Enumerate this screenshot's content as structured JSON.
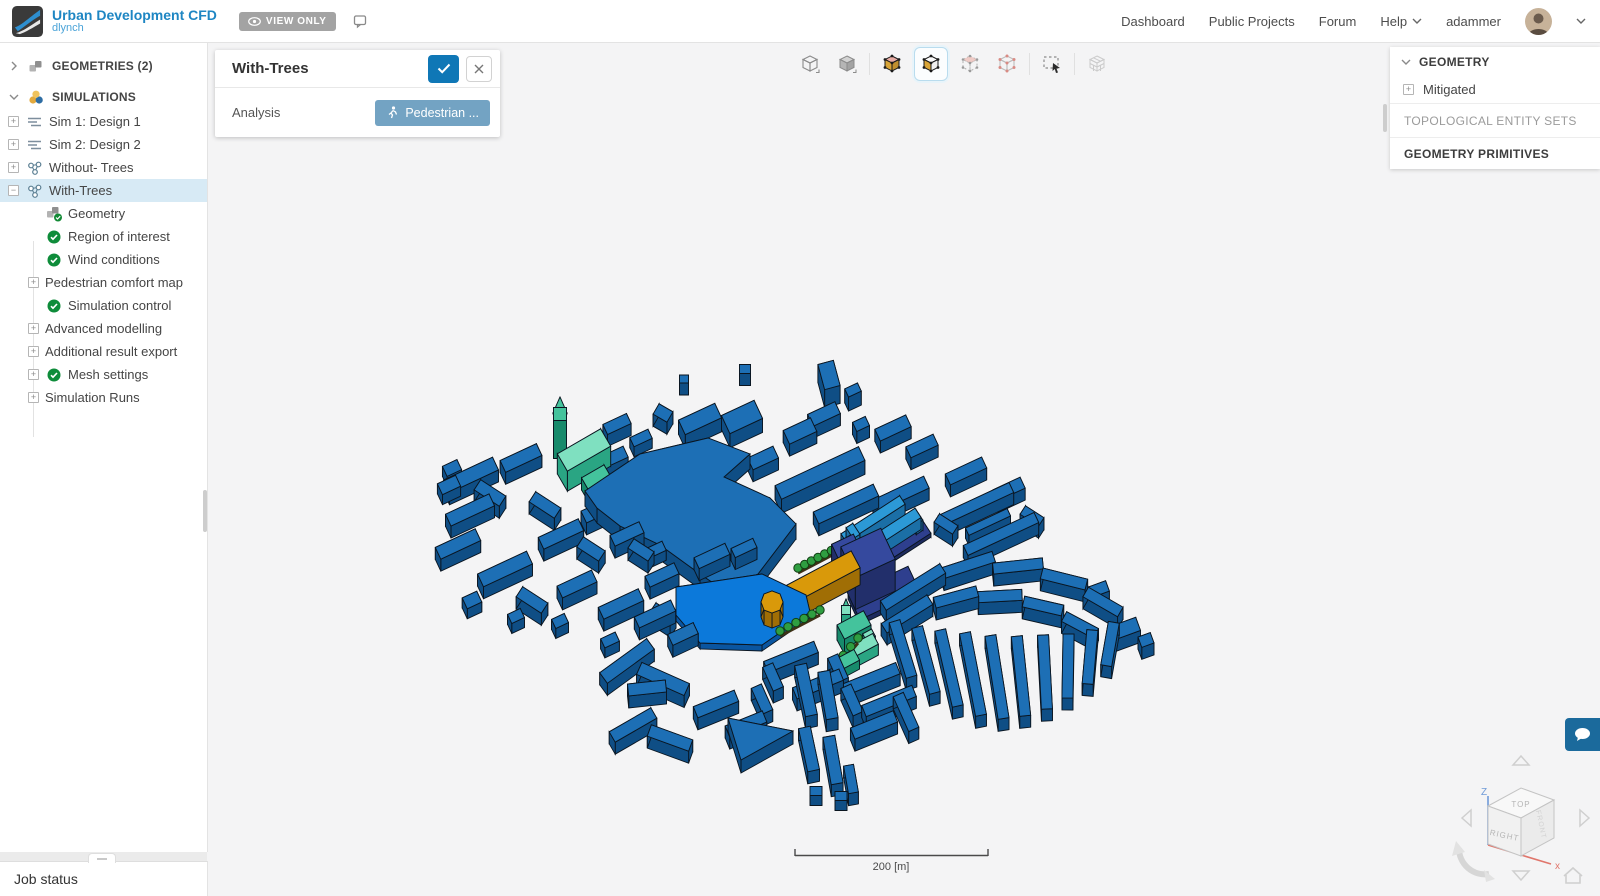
{
  "header": {
    "brand": {
      "title": "Urban Development CFD",
      "owner": "dlynch"
    },
    "view_only_label": "VIEW ONLY",
    "nav": {
      "dashboard": "Dashboard",
      "public_projects": "Public Projects",
      "forum": "Forum",
      "help": "Help",
      "username": "adammer"
    }
  },
  "sidebar": {
    "tree": [
      {
        "label": "GEOMETRIES (2)"
      },
      {
        "label": "SIMULATIONS"
      },
      {
        "label": "Sim 1: Design 1"
      },
      {
        "label": "Sim 2: Design 2"
      },
      {
        "label": "Without- Trees"
      },
      {
        "label": "With-Trees"
      },
      {
        "label": "Geometry"
      },
      {
        "label": "Region of interest"
      },
      {
        "label": "Wind conditions"
      },
      {
        "label": "Pedestrian comfort map"
      },
      {
        "label": "Simulation control"
      },
      {
        "label": "Advanced modelling"
      },
      {
        "label": "Additional result export"
      },
      {
        "label": "Mesh settings"
      },
      {
        "label": "Simulation Runs"
      }
    ],
    "job_status_label": "Job status"
  },
  "panel": {
    "title": "With-Trees",
    "field_label": "Analysis",
    "field_value": "Pedestrian ..."
  },
  "toolbar": {
    "icons": [
      "wireframe-view",
      "solid-view",
      "shaded-with-edges-view",
      "shaded-view",
      "vertex-selection-view",
      "primitive-selection-view",
      "box-select-tool",
      "mesh-view"
    ]
  },
  "right_panel": {
    "geometry_label": "GEOMETRY",
    "mitigated_label": "Mitigated",
    "topological_label": "TOPOLOGICAL ENTITY SETS",
    "primitives_label": "GEOMETRY PRIMITIVES"
  },
  "viewport": {
    "scale_label": "200 [m]",
    "cube": {
      "top": "TOP",
      "front": "RIGHT",
      "side": "FRONT",
      "z_axis": "Z",
      "x_axis": "x"
    },
    "colors": {
      "stroke": "#0a1520",
      "b": {
        "t": "#1d6fb5",
        "s": "#0f4e85"
      },
      "p": {
        "t": "#0c79da",
        "s": "#0a55a0"
      },
      "o": {
        "t": "#d9990a",
        "s": "#a06e05"
      },
      "n": {
        "t": "#35499e",
        "s": "#222f6b"
      },
      "np": {
        "t": "#2e3f8e",
        "s": "#1d2a5e"
      },
      "c": {
        "t": "#2c99d6",
        "s": "#1b6fa6"
      },
      "m": {
        "t": "#7fe0c0",
        "s": "#2aa583"
      },
      "m2": {
        "t": "#44c39c",
        "s": "#178a6b"
      }
    },
    "tree_color": "#2f9e41",
    "buildings": [
      [
        617,
        436,
        26,
        11,
        -25,
        12,
        "b"
      ],
      [
        641,
        448,
        20,
        10,
        -25,
        10,
        "b"
      ],
      [
        612,
        470,
        30,
        12,
        -25,
        12,
        "b"
      ],
      [
        663,
        425,
        16,
        12,
        30,
        12,
        "b"
      ],
      [
        684,
        391,
        9,
        8,
        0,
        12,
        "b"
      ],
      [
        700,
        433,
        40,
        16,
        -25,
        14,
        "b"
      ],
      [
        745,
        381,
        11,
        9,
        0,
        12,
        "b"
      ],
      [
        742,
        431,
        36,
        20,
        -25,
        14,
        "b"
      ],
      [
        763,
        470,
        28,
        13,
        -25,
        12,
        "b"
      ],
      [
        800,
        443,
        30,
        15,
        -25,
        12,
        "b"
      ],
      [
        829,
        393,
        16,
        26,
        -15,
        18,
        "b"
      ],
      [
        824,
        426,
        30,
        13,
        -25,
        12,
        "b"
      ],
      [
        853,
        404,
        14,
        9,
        -25,
        14,
        "b"
      ],
      [
        861,
        436,
        14,
        10,
        -25,
        12,
        "b"
      ],
      [
        893,
        440,
        34,
        13,
        -25,
        12,
        "b"
      ],
      [
        922,
        458,
        30,
        12,
        -25,
        12,
        "b"
      ],
      [
        452,
        478,
        16,
        11,
        -25,
        10,
        "b"
      ],
      [
        449,
        495,
        20,
        12,
        -25,
        10,
        "b"
      ],
      [
        560,
        452,
        13,
        13,
        0,
        38,
        "m2"
      ],
      [
        584,
        470,
        50,
        20,
        -30,
        20,
        "m"
      ],
      [
        596,
        489,
        26,
        13,
        -30,
        12,
        "m2"
      ],
      [
        606,
        497,
        12,
        10,
        -30,
        10,
        "m2"
      ],
      [
        615,
        487,
        10,
        9,
        -30,
        8,
        "m2"
      ],
      [
        471,
        487,
        54,
        14,
        -25,
        12,
        "b"
      ],
      [
        521,
        470,
        40,
        13,
        -25,
        12,
        "b"
      ],
      [
        490,
        505,
        30,
        12,
        33,
        12,
        "b"
      ],
      [
        470,
        522,
        48,
        13,
        -25,
        12,
        "b"
      ],
      [
        545,
        517,
        30,
        12,
        33,
        12,
        "b"
      ],
      [
        458,
        556,
        44,
        13,
        -25,
        12,
        "b"
      ],
      [
        505,
        581,
        54,
        14,
        -25,
        12,
        "b"
      ],
      [
        561,
        546,
        44,
        13,
        -25,
        12,
        "b"
      ],
      [
        601,
        521,
        38,
        13,
        -25,
        12,
        "b"
      ],
      [
        591,
        561,
        26,
        12,
        33,
        12,
        "b"
      ],
      [
        627,
        546,
        32,
        12,
        -25,
        12,
        "b"
      ],
      [
        641,
        562,
        24,
        11,
        33,
        12,
        "b"
      ],
      [
        532,
        612,
        30,
        12,
        33,
        12,
        "b"
      ],
      [
        577,
        596,
        38,
        13,
        -25,
        12,
        "b"
      ],
      [
        621,
        616,
        44,
        13,
        -25,
        12,
        "b"
      ],
      [
        662,
        587,
        32,
        12,
        -25,
        12,
        "b"
      ],
      [
        663,
        626,
        24,
        11,
        33,
        12,
        "b"
      ],
      [
        472,
        610,
        16,
        12,
        -25,
        10,
        "b"
      ],
      [
        516,
        626,
        14,
        10,
        -25,
        10,
        "b"
      ],
      [
        560,
        631,
        14,
        10,
        -25,
        10,
        "b"
      ],
      [
        655,
        560,
        20,
        10,
        -25,
        10,
        "b"
      ],
      [
        712,
        568,
        34,
        12,
        -25,
        12,
        "b"
      ],
      [
        744,
        560,
        24,
        10,
        -25,
        12,
        "b"
      ],
      [
        655,
        626,
        40,
        12,
        -25,
        12,
        "b"
      ],
      [
        683,
        646,
        28,
        12,
        -25,
        12,
        "b"
      ],
      [
        820,
        487,
        92,
        15,
        -25,
        14,
        "b"
      ],
      [
        846,
        516,
        66,
        13,
        -25,
        12,
        "b"
      ],
      [
        901,
        506,
        56,
        13,
        -25,
        12,
        "b"
      ],
      [
        966,
        483,
        40,
        12,
        -25,
        12,
        "b"
      ],
      [
        1009,
        501,
        30,
        12,
        -25,
        12,
        "b"
      ],
      [
        976,
        516,
        78,
        11,
        -25,
        12,
        "b"
      ],
      [
        1001,
        546,
        78,
        11,
        -25,
        12,
        "b"
      ],
      [
        946,
        536,
        22,
        10,
        33,
        12,
        "b"
      ],
      [
        1032,
        528,
        22,
        10,
        33,
        12,
        "b"
      ],
      [
        988,
        532,
        46,
        8,
        -25,
        10,
        "b"
      ],
      [
        888,
        552,
        88,
        22,
        -33,
        4,
        "np",
        518
      ],
      [
        873,
        531,
        70,
        10,
        -33,
        12,
        "c"
      ],
      [
        887,
        545,
        74,
        11,
        -33,
        12,
        "c"
      ],
      [
        853,
        541,
        13,
        8,
        57,
        10,
        "c"
      ],
      [
        916,
        527,
        13,
        8,
        57,
        10,
        "c"
      ],
      [
        848,
        577,
        24,
        26,
        -25,
        26,
        "n"
      ],
      [
        868,
        585,
        44,
        34,
        -25,
        32,
        "n"
      ],
      [
        884,
        598,
        66,
        28,
        -25,
        5,
        "np",
        560
      ],
      [
        815,
        598,
        92,
        19,
        -28,
        17,
        "o"
      ],
      [
        858,
        578,
        13,
        11,
        -28,
        13,
        "o"
      ],
      [
        854,
        640,
        30,
        16,
        -28,
        15,
        "m2"
      ],
      [
        864,
        656,
        26,
        12,
        -28,
        11,
        "m"
      ],
      [
        847,
        669,
        22,
        12,
        -28,
        9,
        "m2"
      ],
      [
        846,
        634,
        9,
        9,
        0,
        24,
        "m"
      ],
      [
        869,
        643,
        10,
        8,
        -28,
        8,
        "m"
      ],
      [
        913,
        599,
        70,
        11,
        -32,
        12,
        "b"
      ],
      [
        968,
        577,
        54,
        11,
        -18,
        12,
        "b"
      ],
      [
        1018,
        578,
        50,
        11,
        -6,
        12,
        "b"
      ],
      [
        1064,
        591,
        46,
        11,
        14,
        12,
        "b"
      ],
      [
        1103,
        614,
        40,
        11,
        30,
        12,
        "b"
      ],
      [
        907,
        626,
        54,
        11,
        -32,
        12,
        "b"
      ],
      [
        956,
        609,
        44,
        11,
        -15,
        12,
        "b"
      ],
      [
        1000,
        608,
        44,
        11,
        -3,
        12,
        "b"
      ],
      [
        1043,
        618,
        40,
        11,
        13,
        12,
        "b"
      ],
      [
        1080,
        637,
        36,
        11,
        28,
        12,
        "b"
      ],
      [
        903,
        661,
        58,
        11,
        73,
        12,
        "b"
      ],
      [
        926,
        672,
        68,
        11,
        75,
        12,
        "b"
      ],
      [
        949,
        680,
        78,
        11,
        77,
        12,
        "b"
      ],
      [
        973,
        686,
        84,
        11,
        79,
        12,
        "b"
      ],
      [
        997,
        689,
        84,
        11,
        81,
        12,
        "b"
      ],
      [
        1021,
        688,
        80,
        11,
        84,
        12,
        "b"
      ],
      [
        1045,
        684,
        74,
        11,
        87,
        12,
        "b"
      ],
      [
        1068,
        678,
        64,
        11,
        91,
        12,
        "b"
      ],
      [
        1090,
        669,
        54,
        11,
        95,
        12,
        "b"
      ],
      [
        1110,
        656,
        44,
        11,
        100,
        12,
        "b"
      ],
      [
        1124,
        641,
        30,
        14,
        -20,
        12,
        "b"
      ],
      [
        1146,
        652,
        13,
        11,
        -20,
        12,
        "b"
      ],
      [
        1099,
        601,
        18,
        11,
        -20,
        12,
        "b"
      ],
      [
        627,
        673,
        58,
        13,
        -36,
        12,
        "b"
      ],
      [
        663,
        691,
        52,
        13,
        24,
        12,
        "b"
      ],
      [
        647,
        700,
        38,
        12,
        -6,
        12,
        "b"
      ],
      [
        633,
        737,
        48,
        12,
        -30,
        12,
        "b"
      ],
      [
        670,
        750,
        44,
        12,
        20,
        12,
        "b"
      ],
      [
        610,
        650,
        16,
        10,
        -25,
        10,
        "b"
      ],
      [
        791,
        669,
        54,
        12,
        -22,
        12,
        "b"
      ],
      [
        818,
        696,
        50,
        12,
        -22,
        12,
        "b"
      ],
      [
        773,
        689,
        26,
        11,
        66,
        12,
        "b"
      ],
      [
        838,
        680,
        26,
        11,
        66,
        12,
        "b"
      ],
      [
        806,
        702,
        52,
        12,
        78,
        12,
        "b"
      ],
      [
        828,
        707,
        48,
        12,
        80,
        12,
        "b"
      ],
      [
        871,
        691,
        58,
        12,
        -22,
        12,
        "b"
      ],
      [
        889,
        713,
        54,
        12,
        -22,
        12,
        "b"
      ],
      [
        852,
        712,
        30,
        11,
        66,
        12,
        "b"
      ],
      [
        906,
        724,
        38,
        11,
        66,
        12,
        "b"
      ],
      [
        874,
        737,
        46,
        12,
        -22,
        12,
        "b"
      ],
      [
        716,
        716,
        44,
        12,
        -22,
        12,
        "b"
      ],
      [
        746,
        736,
        40,
        12,
        -22,
        12,
        "b"
      ],
      [
        762,
        711,
        28,
        11,
        66,
        12,
        "b"
      ],
      [
        809,
        761,
        44,
        12,
        78,
        12,
        "b"
      ],
      [
        833,
        772,
        48,
        12,
        80,
        12,
        "b"
      ],
      [
        851,
        791,
        28,
        10,
        80,
        12,
        "b"
      ],
      [
        816,
        801,
        12,
        9,
        0,
        10,
        "b"
      ],
      [
        841,
        806,
        12,
        9,
        0,
        10,
        "b"
      ]
    ],
    "polygons": [
      {
        "pts": [
          [
            585,
            506
          ],
          [
            640,
            469
          ],
          [
            708,
            453
          ],
          [
            750,
            469
          ],
          [
            724,
            492
          ],
          [
            770,
            513
          ],
          [
            796,
            539
          ],
          [
            758,
            589
          ],
          [
            722,
            604
          ],
          [
            700,
            589
          ],
          [
            660,
            560
          ],
          [
            620,
            541
          ],
          [
            597,
            523
          ]
        ],
        "h": 15,
        "c": "b"
      },
      {
        "pts": [
          [
            676,
            593
          ],
          [
            762,
            580
          ],
          [
            806,
            601
          ],
          [
            810,
            618
          ],
          [
            762,
            651
          ],
          [
            700,
            649
          ],
          [
            676,
            621
          ]
        ],
        "h": 6,
        "c": "p"
      },
      {
        "pts": [
          [
            728,
            731
          ],
          [
            793,
            744
          ],
          [
            741,
            773
          ]
        ],
        "h": 13,
        "c": "b"
      },
      {
        "pts": [
          [
            783,
            617
          ],
          [
            780,
            625
          ],
          [
            772,
            628
          ],
          [
            764,
            625
          ],
          [
            761,
            617
          ],
          [
            764,
            609
          ],
          [
            772,
            606
          ],
          [
            780,
            609
          ]
        ],
        "h": 15,
        "c": "o"
      },
      {
        "pts": [
          [
            553,
            414
          ],
          [
            567,
            414
          ],
          [
            560,
            398
          ]
        ],
        "h": 1,
        "c": "m2"
      },
      {
        "pts": [
          [
            842,
            610
          ],
          [
            850,
            610
          ],
          [
            846,
            600
          ]
        ],
        "h": 1,
        "c": "m2"
      }
    ],
    "tree_rows": [
      {
        "x1": 798,
        "y1": 568,
        "x2": 838,
        "y2": 547,
        "n": 7
      },
      {
        "x1": 780,
        "y1": 631,
        "x2": 820,
        "y2": 610,
        "n": 6
      },
      {
        "x1": 836,
        "y1": 664,
        "x2": 858,
        "y2": 638,
        "n": 4
      }
    ]
  }
}
